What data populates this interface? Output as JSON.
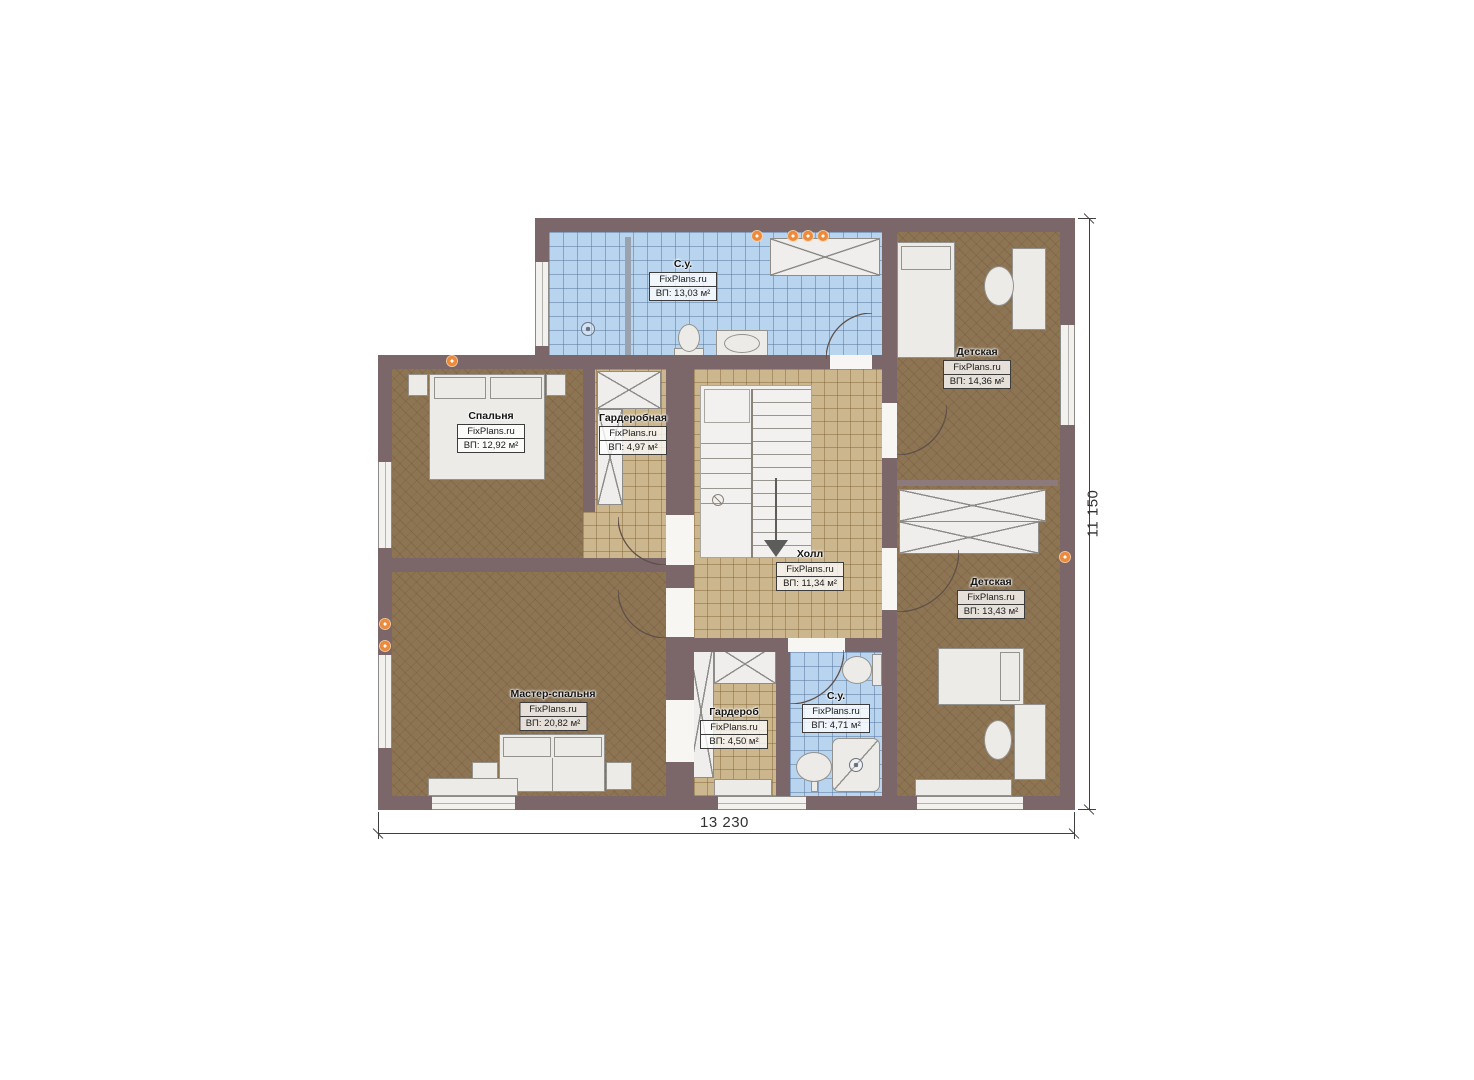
{
  "plan": {
    "site_watermark": "FixPlans.ru",
    "rooms": [
      {
        "name": "С.у.",
        "site": "FixPlans.ru",
        "area": "ВП: 13,03 м²"
      },
      {
        "name": "Детская",
        "site": "FixPlans.ru",
        "area": "ВП: 14,36 м²"
      },
      {
        "name": "Спальня",
        "site": "FixPlans.ru",
        "area": "ВП: 12,92 м²"
      },
      {
        "name": "Гардеробная",
        "site": "FixPlans.ru",
        "area": "ВП: 4,97 м²"
      },
      {
        "name": "Холл",
        "site": "FixPlans.ru",
        "area": "ВП: 11,34 м²"
      },
      {
        "name": "Детская",
        "site": "FixPlans.ru",
        "area": "ВП: 13,43 м²"
      },
      {
        "name": "Мастер-спальня",
        "site": "FixPlans.ru",
        "area": "ВП: 20,82 м²"
      },
      {
        "name": "Гардероб",
        "site": "FixPlans.ru",
        "area": "ВП: 4,50 м²"
      },
      {
        "name": "С.у.",
        "site": "FixPlans.ru",
        "area": "ВП: 4,71 м²"
      }
    ],
    "dimensions": {
      "width_label": "13 230",
      "height_label": "11 150"
    },
    "colors": {
      "wall": "#7b666a",
      "wood_floor": "#8d7453",
      "tile_floor": "#ccb68d",
      "bath_tile": "#b9d4ee",
      "vent_accent": "#ee8a3a",
      "furniture": "#ecebe8"
    }
  }
}
